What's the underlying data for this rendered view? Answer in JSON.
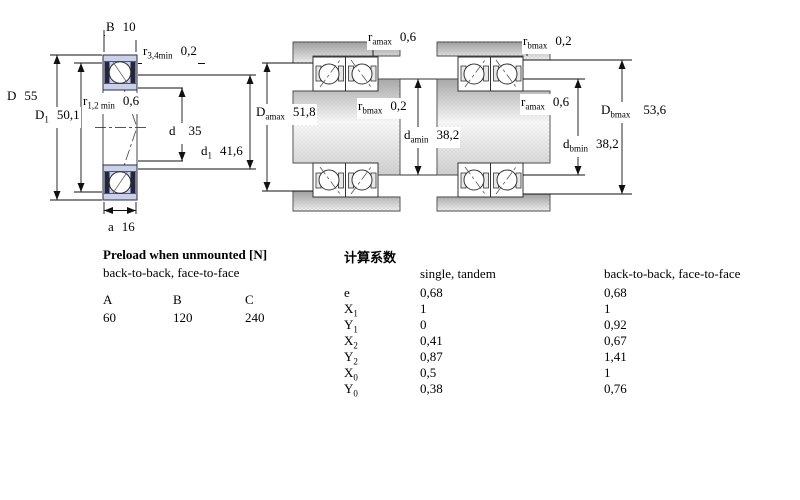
{
  "diagrams": {
    "left": {
      "dims": {
        "B": {
          "sym": "B",
          "sub": "",
          "value": "10"
        },
        "r34": {
          "sym": "r",
          "sub": "3,4min",
          "value": "0,2"
        },
        "D": {
          "sym": "D",
          "sub": "",
          "value": "55"
        },
        "r12": {
          "sym": "r",
          "sub": "1,2 min",
          "value": "0,6"
        },
        "D1": {
          "sym": "D",
          "sub": "1",
          "value": "50,1"
        },
        "d": {
          "sym": "d",
          "sub": "",
          "value": "35"
        },
        "d1": {
          "sym": "d",
          "sub": "1",
          "value": "41,6"
        },
        "a": {
          "sym": "a",
          "sub": "",
          "value": "16"
        }
      }
    },
    "middle": {
      "dims": {
        "ramax": {
          "sym": "r",
          "sub": "amax",
          "value": "0,6"
        },
        "Damax": {
          "sym": "D",
          "sub": "amax",
          "value": "51,8"
        },
        "rbmax": {
          "sym": "r",
          "sub": "bmax",
          "value": "0,2"
        },
        "damin": {
          "sym": "d",
          "sub": "amin",
          "value": "38,2"
        }
      }
    },
    "right": {
      "dims": {
        "rbmax": {
          "sym": "r",
          "sub": "bmax",
          "value": "0,2"
        },
        "ramax": {
          "sym": "r",
          "sub": "amax",
          "value": "0,6"
        },
        "Dbmax": {
          "sym": "D",
          "sub": "bmax",
          "value": "53,6"
        },
        "dbmin": {
          "sym": "d",
          "sub": "bmin",
          "value": "38,2"
        }
      }
    }
  },
  "preload_table": {
    "title": "Preload when unmounted [N]",
    "subtitle": "back-to-back, face-to-face",
    "columns": [
      {
        "header": "A",
        "value": "60"
      },
      {
        "header": "B",
        "value": "120"
      },
      {
        "header": "C",
        "value": "240"
      }
    ]
  },
  "factors_table": {
    "title": "计算系数",
    "col1_header": "single, tandem",
    "col2_header": "back-to-back, face-to-face",
    "rows": [
      {
        "sym": "e",
        "sub": "",
        "single": "0,68",
        "btb": "0,68"
      },
      {
        "sym": "X",
        "sub": "1",
        "single": "1",
        "btb": "1"
      },
      {
        "sym": "Y",
        "sub": "1",
        "single": "0",
        "btb": "0,92"
      },
      {
        "sym": "X",
        "sub": "2",
        "single": "0,41",
        "btb": "0,67"
      },
      {
        "sym": "Y",
        "sub": "2",
        "single": "0,87",
        "btb": "1,41"
      },
      {
        "sym": "X",
        "sub": "0",
        "single": "0,5",
        "btb": "1"
      },
      {
        "sym": "Y",
        "sub": "0",
        "single": "0,38",
        "btb": "0,76"
      }
    ]
  },
  "colors": {
    "ring_fill": "#c9d0ea",
    "dark_detail": "#26263a",
    "line": "#222222"
  }
}
